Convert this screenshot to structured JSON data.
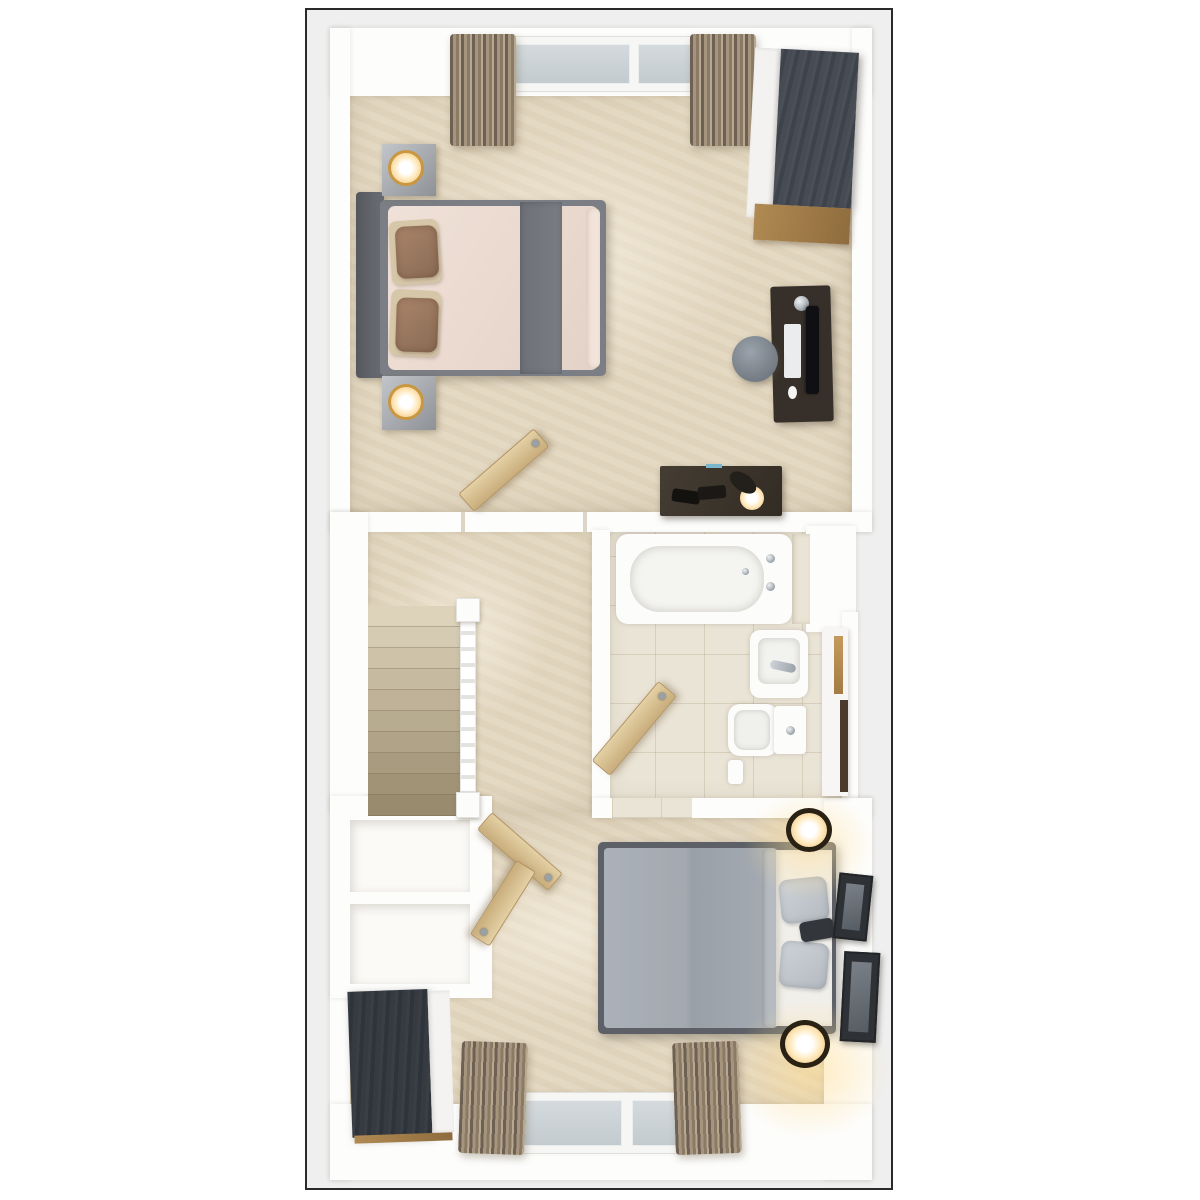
{
  "meta": {
    "scene_label": "Top-down 3D floor plan render of an upper storey",
    "view": "plan view 3D render",
    "visible_text": ""
  },
  "palette": {
    "panel_bg": "#efefef",
    "panel_border": "#2a2a2c",
    "wall": "#fdfdfc",
    "carpet": "#e3d7c0",
    "tile": "#eae4d6",
    "stair_top": "#ddd2ba",
    "stair_bottom": "#998b6e",
    "door_wood": "#d6bc8c",
    "dark_wood": "#42464e",
    "oak_accent": "#a07c48",
    "curtain": "#8b7b66",
    "glass": "#cdd4d8",
    "bed1_duvet": "#ecdcd2",
    "bed1_runner": "#74777d",
    "bed1_frame": "#7b7f85",
    "bed1_pillow": "#9c7b64",
    "bed2_duvet": "#a3a9b0",
    "bed2_frame": "#5d6167",
    "bed2_pillow": "#c6cbd0",
    "desk_wood": "#37302a",
    "lamp_glow": "#f2d2a0",
    "fixture_white": "#fcfcfb"
  },
  "floorplan": {
    "rooms": [
      {
        "id": "bedroom-1",
        "label": "Bedroom 1 (top)",
        "furniture": [
          "double bed with grey frame, blush duvet, grey runner, brown pillows",
          "upholstered headboard",
          "two grey bedside tables with glowing table lamps",
          "dark wood wardrobe with white doors and oak base",
          "dark wood desk with monitor, keyboard, mouse and chrome lamp",
          "round grey stool",
          "low dark dresser with black reading lamp and books",
          "window with two panes",
          "two pleated curtains",
          "open door"
        ]
      },
      {
        "id": "landing",
        "label": "Landing with staircase",
        "furniture": [
          "carpeted staircase descending",
          "white banister with newel posts",
          "open doors to rooms"
        ]
      },
      {
        "id": "bathroom",
        "label": "Bathroom",
        "furniture": [
          "white bathtub with chrome taps",
          "wall basin with chrome tap",
          "toilet with cistern",
          "tall storage unit with oak and dark accents",
          "open door",
          "tiled floor"
        ]
      },
      {
        "id": "bedroom-2",
        "label": "Bedroom 2 (bottom)",
        "furniture": [
          "double bed with grey duvet and grey pillows",
          "white bed surround",
          "two dark drum bedside lamps glowing",
          "two framed pictures on wall",
          "dark wood wardrobe with white side",
          "two white storage cupboards",
          "window with two panes",
          "two pleated curtains",
          "two open doors"
        ]
      }
    ],
    "stairs": {
      "step_count": 10,
      "direction": "down toward lower floor"
    },
    "windows": [
      {
        "room": "bedroom-1",
        "position": "top wall",
        "panes": 2
      },
      {
        "room": "bedroom-2",
        "position": "bottom wall",
        "panes": 2
      }
    ],
    "doors_open": 4
  }
}
